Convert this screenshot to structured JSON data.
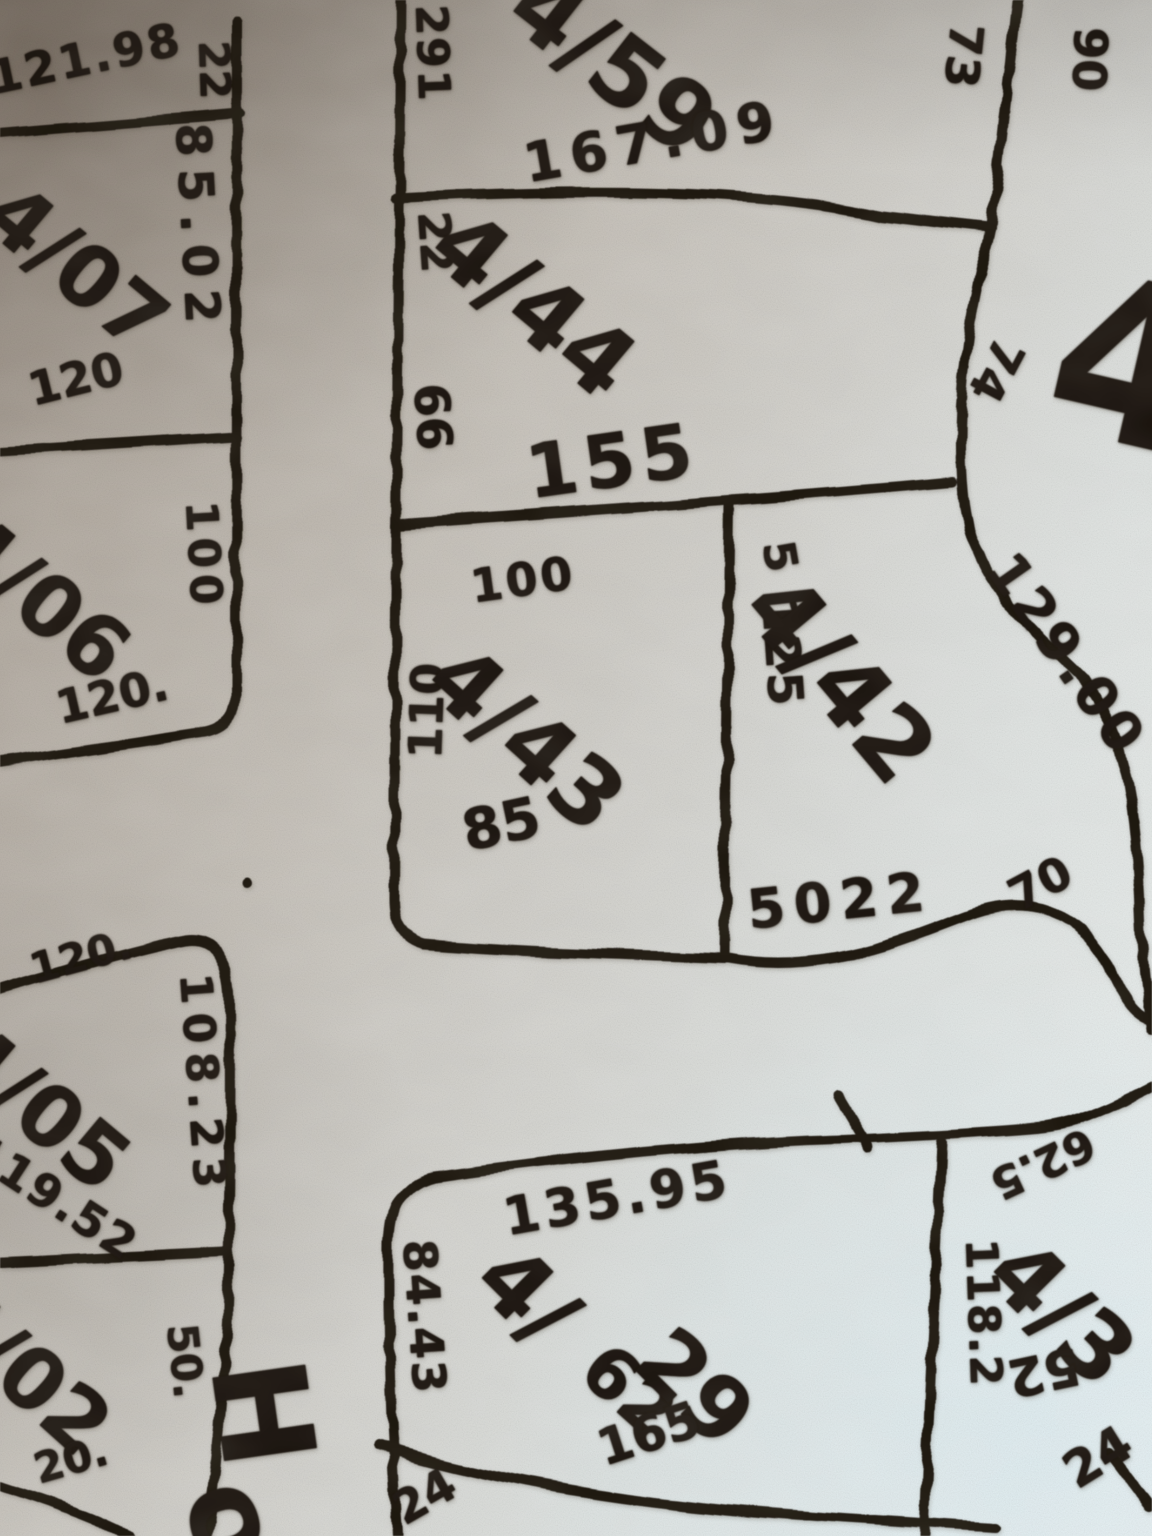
{
  "photo": {
    "type": "hand-drawn plat map photographed close-up",
    "ink_color": "#1b1510",
    "paper_dark": "#93897e",
    "paper_light": "#eef2f2"
  },
  "street": {
    "name_partial": "Ho",
    "letters": {
      "h": "H",
      "o": "o"
    }
  },
  "parcels": {
    "nw": {
      "label": "4/07",
      "top": "121.98",
      "right": "85.02",
      "bottom": "120",
      "corner": "22"
    },
    "w": {
      "label": "4/06",
      "right": "100",
      "bottom": "120."
    },
    "sw": {
      "label": "4/05",
      "top": "120.",
      "mid": "119.52",
      "right": "108.23"
    },
    "sw2": {
      "label": "4/02",
      "right": "50.",
      "bottom": "20."
    },
    "n": {
      "label": "4/59",
      "bottom": "167.09",
      "left": "291",
      "right": "73",
      "far_right": "90"
    },
    "c1": {
      "label": "4/44",
      "area": "155",
      "left_top": "22",
      "left_bottom": "66"
    },
    "c2": {
      "label": "4/43",
      "top": "100",
      "left": "110",
      "bottom": "85"
    },
    "c3": {
      "label": "4/42",
      "left_top": "5",
      "left": "125",
      "bottom": "5022",
      "bottom_right": "70"
    },
    "e": {
      "label": "4",
      "curve": "129.00",
      "inner": "74"
    },
    "s1": {
      "label_a": "4/",
      "label_b": "29",
      "mid": "62",
      "top": "135.95",
      "left": "84.43",
      "bottom": "165",
      "corner": "24"
    },
    "s2": {
      "label": "4/3",
      "top_right": "62.5",
      "left": "118.2",
      "mid": "52",
      "bottom": "24"
    }
  }
}
